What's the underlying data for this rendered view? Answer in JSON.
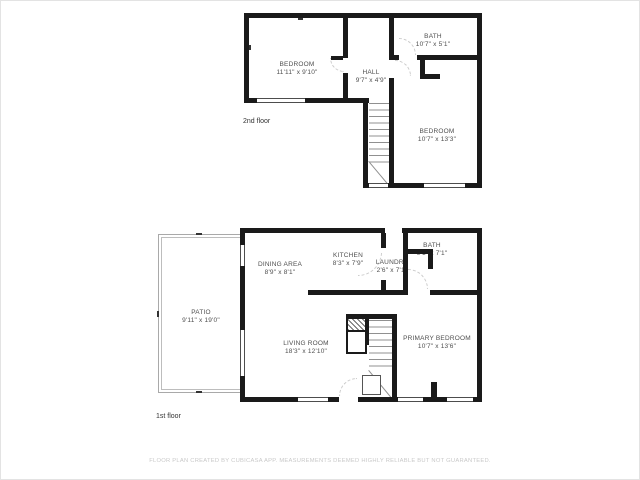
{
  "document": {
    "type": "floor-plan",
    "footer": "FLOOR PLAN CREATED BY CUBICASA APP. MEASUREMENTS DEEMED HIGHLY RELIABLE BUT NOT GUARANTEED."
  },
  "colors": {
    "wall": "#1a1a1a",
    "room_label": "#4f4f4f",
    "floor_label": "#333333",
    "footer_text": "#c9c9c9",
    "background": "#ffffff"
  },
  "floors": [
    {
      "label": "2nd floor",
      "rooms": [
        {
          "name": "BEDROOM",
          "dims": "11'11\" x 9'10\""
        },
        {
          "name": "BATH",
          "dims": "10'7\" x 5'1\""
        },
        {
          "name": "HALL",
          "dims": "9'7\" x 4'9\""
        },
        {
          "name": "BEDROOM",
          "dims": "10'7\" x 13'3\""
        }
      ]
    },
    {
      "label": "1st floor",
      "rooms": [
        {
          "name": "PATIO",
          "dims": "9'11\" x 19'0\""
        },
        {
          "name": "DINING AREA",
          "dims": "8'9\" x 8'1\""
        },
        {
          "name": "KITCHEN",
          "dims": "8'3\" x 7'9\""
        },
        {
          "name": "LAUNDRY",
          "dims": "2'6\" x 7'1\""
        },
        {
          "name": "BATH",
          "dims": "9'1\" x 7'1\""
        },
        {
          "name": "LIVING ROOM",
          "dims": "18'3\" x 12'10\""
        },
        {
          "name": "PRIMARY BEDROOM",
          "dims": "10'7\" x 13'6\""
        }
      ]
    }
  ]
}
